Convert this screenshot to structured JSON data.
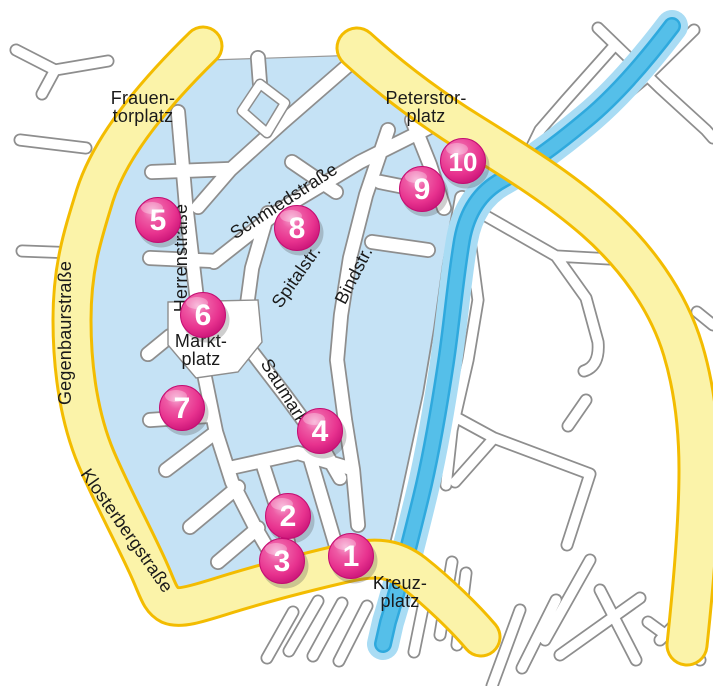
{
  "map": {
    "title": "Old town map with numbered sights",
    "colors": {
      "background": "#FFFFFF",
      "town_fill": "#C5E2F5",
      "town_border": "#999999",
      "street_fill": "#FFFFFF",
      "street_casing": "#8E8E8E",
      "river_light": "#A9DCF4",
      "river_mid": "#2FA9DD",
      "river_core": "#55BFE9",
      "ring_road_fill": "#FBF3A9",
      "ring_road_border": "#F3BC00",
      "marker_main": "#E8338F",
      "marker_dark": "#C30D72",
      "marker_light": "#F590C6",
      "marker_number": "#FFFFFF",
      "label_color": "#1A1A1A"
    },
    "markers": [
      {
        "number": "1",
        "x": 351,
        "y": 556
      },
      {
        "number": "2",
        "x": 288,
        "y": 516
      },
      {
        "number": "3",
        "x": 282,
        "y": 561
      },
      {
        "number": "4",
        "x": 320,
        "y": 431
      },
      {
        "number": "5",
        "x": 158,
        "y": 220
      },
      {
        "number": "6",
        "x": 203,
        "y": 315
      },
      {
        "number": "7",
        "x": 182,
        "y": 408
      },
      {
        "number": "8",
        "x": 297,
        "y": 228
      },
      {
        "number": "9",
        "x": 422,
        "y": 189
      },
      {
        "number": "10",
        "x": 463,
        "y": 161
      }
    ],
    "labels": [
      {
        "id": "frauentorplatz",
        "lines": [
          "Frauen-",
          "torplatz"
        ],
        "x": 143,
        "y": 104,
        "rotate": 0
      },
      {
        "id": "peterstorplatz",
        "lines": [
          "Peterstor-",
          "platz"
        ],
        "x": 426,
        "y": 104,
        "rotate": 0
      },
      {
        "id": "marktplatz",
        "lines": [
          "Markt-",
          "platz"
        ],
        "x": 201,
        "y": 347,
        "rotate": 0
      },
      {
        "id": "kreuzplatz",
        "lines": [
          "Kreuz-",
          "platz"
        ],
        "x": 400,
        "y": 589,
        "rotate": 0
      },
      {
        "id": "schmiedstrasse",
        "lines": [
          "Schmiedstraße"
        ],
        "x": 287,
        "y": 206,
        "rotate": -33
      },
      {
        "id": "spitalstr",
        "lines": [
          "Spitalstr."
        ],
        "x": 301,
        "y": 280,
        "rotate": -55
      },
      {
        "id": "bindstr",
        "lines": [
          "Bindstr."
        ],
        "x": 359,
        "y": 278,
        "rotate": -63
      },
      {
        "id": "herrenstrasse",
        "lines": [
          "Herrenstraße"
        ],
        "x": 187,
        "y": 258,
        "rotate": -90
      },
      {
        "id": "saumarkt",
        "lines": [
          "Saumarkt"
        ],
        "x": 281,
        "y": 397,
        "rotate": 58
      },
      {
        "id": "gegenbaurstrasse",
        "lines": [
          "Gegenbaurstraße"
        ],
        "x": 71,
        "y": 333,
        "rotate": -90
      },
      {
        "id": "klosterbergstrasse",
        "lines": [
          "Klosterbergstraße"
        ],
        "x": 122,
        "y": 534,
        "rotate": 55
      }
    ]
  }
}
